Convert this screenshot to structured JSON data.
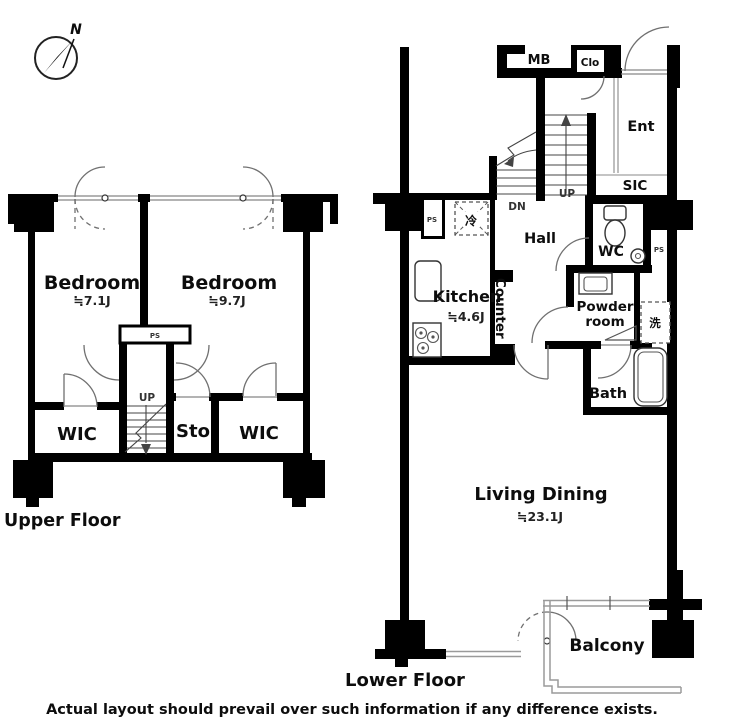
{
  "compass": {
    "north": "N"
  },
  "upper": {
    "floor_label": "Upper Floor",
    "bedroom1": {
      "name": "Bedroom",
      "size": "≒7.1J"
    },
    "bedroom2": {
      "name": "Bedroom",
      "size": "≒9.7J"
    },
    "wic_left": "WIC",
    "sto": "Sto",
    "wic_right": "WIC",
    "stairs_up": "UP",
    "ps": "PS"
  },
  "lower": {
    "floor_label": "Lower Floor",
    "mb": "MB",
    "clo": "Clo",
    "ent": "Ent",
    "sic": "SIC",
    "wc": "WC",
    "ps_right": "PS",
    "ps_left": "PS",
    "fridge": "冷",
    "washer": "洗",
    "hall": "Hall",
    "kitchen": {
      "name": "Kitchen",
      "size": "≒4.6J"
    },
    "counter": "Counter",
    "powder": {
      "line1": "Powder",
      "line2": "room"
    },
    "bath": "Bath",
    "living": {
      "name": "Living Dining",
      "size": "≒23.1J"
    },
    "balcony": "Balcony",
    "stairs_up": "UP",
    "stairs_dn": "DN"
  },
  "footer": {
    "disclaimer": "Actual layout should prevail over such information if any difference exists."
  },
  "colors": {
    "wall": "#000000",
    "window_line": "#9a9a9a",
    "detail_line": "#707070"
  }
}
